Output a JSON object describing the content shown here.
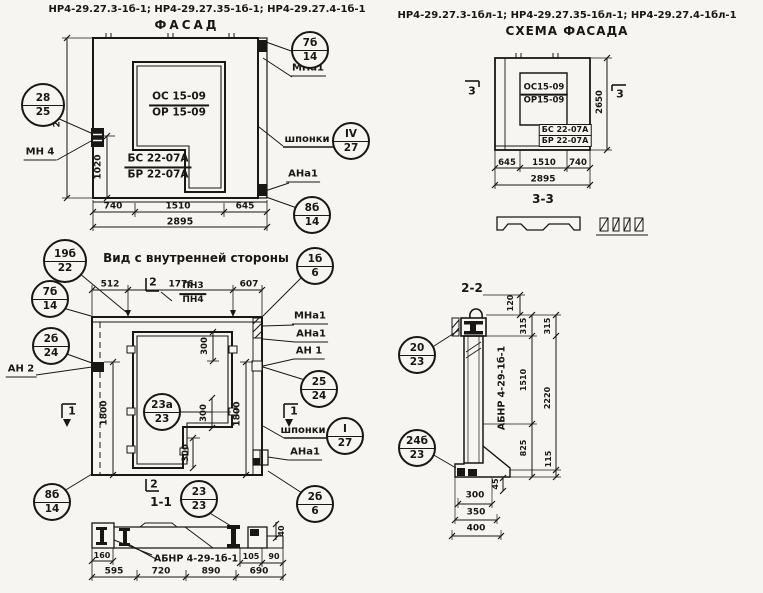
{
  "colors": {
    "paper": "#f6f5f1",
    "ink": "#181716"
  },
  "sheet": {
    "header_left_codes": "НР4-29.27.3-1б-1; НР4-29.27.35-1б-1; НР4-29.27.4-1б-1",
    "facade_title": "ФАСАД",
    "header_right_codes": "НР4-29.27.3-1бл-1; НР4-29.27.35-1бл-1; НР4-29.27.4-1бл-1",
    "scheme_title": "СХЕМА ФАСАДА"
  },
  "facade": {
    "stamp": {
      "os": "ОС 15-09",
      "or": "ОР 15-09",
      "bs": "БС 22-07А",
      "br": "БР 22-07А"
    },
    "dims": {
      "height": "2650",
      "h1020": "1020",
      "b1": "740",
      "b2": "1510",
      "b3": "645",
      "total": "2895"
    },
    "labels": {
      "mn4": "МН 4",
      "mna1": "МНа1",
      "keys": "шпонки",
      "ana1": "АНа1"
    },
    "callouts": {
      "left": {
        "top": "28",
        "bot": "25"
      },
      "tr": {
        "top": "7б",
        "bot": "14"
      },
      "keys": {
        "top": "IV",
        "bot": "27"
      },
      "br": {
        "top": "8б",
        "bot": "14"
      }
    }
  },
  "scheme": {
    "stamp": {
      "os": "ОС15-09",
      "or": "ОР15-09",
      "bs": "БС 22-07А",
      "br": "БР 22-07А"
    },
    "marker_left": "3",
    "marker_right": "3",
    "dims": {
      "height": "2650",
      "b1": "645",
      "b2": "1510",
      "b3": "740",
      "total": "2895"
    },
    "section_label": "3-3"
  },
  "inner": {
    "title": "Вид с внутренней стороны",
    "dims": {
      "t1": "512",
      "t2": "1776",
      "t3": "607",
      "left1800": "1800",
      "right1800": "1800",
      "v300a": "300",
      "v300b": "300",
      "v300c": "300"
    },
    "labels": {
      "pn3": "ПН3",
      "pn4": "ПН4",
      "an2": "АН 2",
      "mna1": "МНа1",
      "ana1_top": "АНа1",
      "an1": "АН 1",
      "keys": "шпонки",
      "ana1_bot": "АНа1"
    },
    "markers": {
      "top": "2",
      "left": "1",
      "right": "1",
      "bottom": "2"
    },
    "section_label": "1-1",
    "callouts": {
      "c19b": {
        "top": "19б",
        "bot": "22"
      },
      "c7b": {
        "top": "7б",
        "bot": "14"
      },
      "c2b24": {
        "top": "2б",
        "bot": "24"
      },
      "c1b6": {
        "top": "1б",
        "bot": "6"
      },
      "c25": {
        "top": "25",
        "bot": "24"
      },
      "keys": {
        "top": "I",
        "bot": "27"
      },
      "c23a": {
        "top": "23а",
        "bot": "23"
      },
      "c8b": {
        "top": "8б",
        "bot": "14"
      },
      "c23": {
        "top": "23",
        "bot": "23"
      },
      "c2b6": {
        "top": "2б",
        "bot": "6"
      }
    }
  },
  "section11": {
    "label": "АБНР 4-29-1б-1",
    "dims": {
      "d160": "160",
      "d105": "105",
      "d90": "90",
      "d40": "40",
      "b1": "595",
      "b2": "720",
      "b3": "890",
      "b4": "690"
    }
  },
  "section22": {
    "title": "2-2",
    "label": "АБНР 4-29-1б-1",
    "callouts": {
      "c20": {
        "top": "20",
        "bot": "23"
      },
      "c24b": {
        "top": "24б",
        "bot": "23"
      }
    },
    "dims": {
      "d120": "120",
      "i1": "315",
      "i2": "1510",
      "i3": "825",
      "o1": "315",
      "o2": "2220",
      "o3": "115",
      "d45": "45",
      "s1": "300",
      "s2": "350",
      "s3": "400"
    }
  }
}
